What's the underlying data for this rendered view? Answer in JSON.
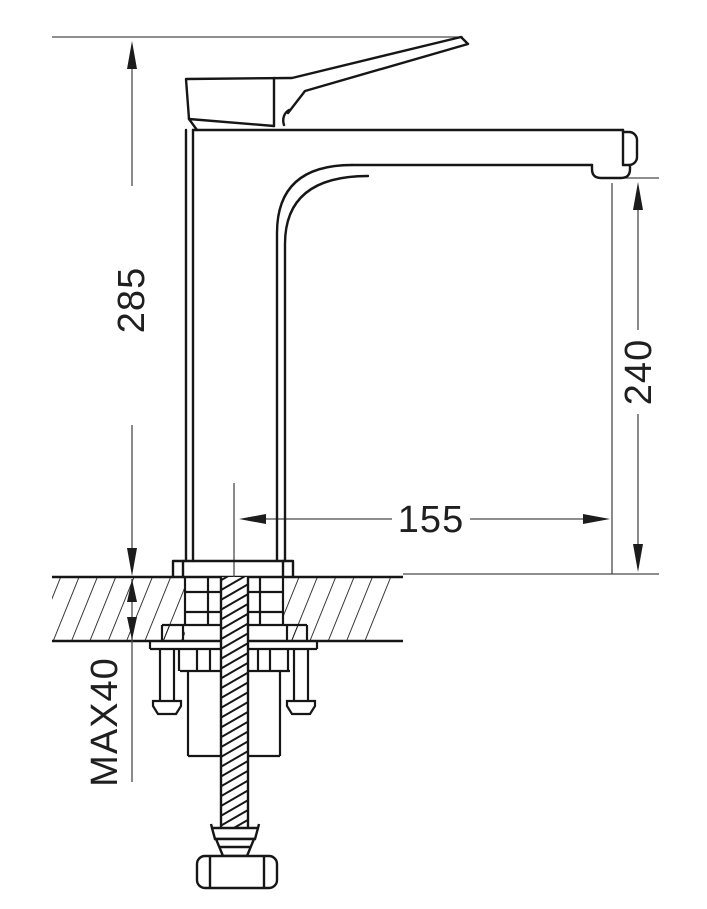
{
  "drawing": {
    "kind": "technical dimension drawing",
    "subject": "single-lever basin mixer tap, side elevation with deck-mount installation cross-section",
    "dimensions": {
      "total_height": "285",
      "outlet_height": "240",
      "spout_reach": "155",
      "max_deck_thickness": "MAX40"
    },
    "colors": {
      "object_line": "#161616",
      "dimension_line": "#4a4a4a",
      "arrowhead": "#1c1c1c",
      "background": "#ffffff"
    }
  }
}
